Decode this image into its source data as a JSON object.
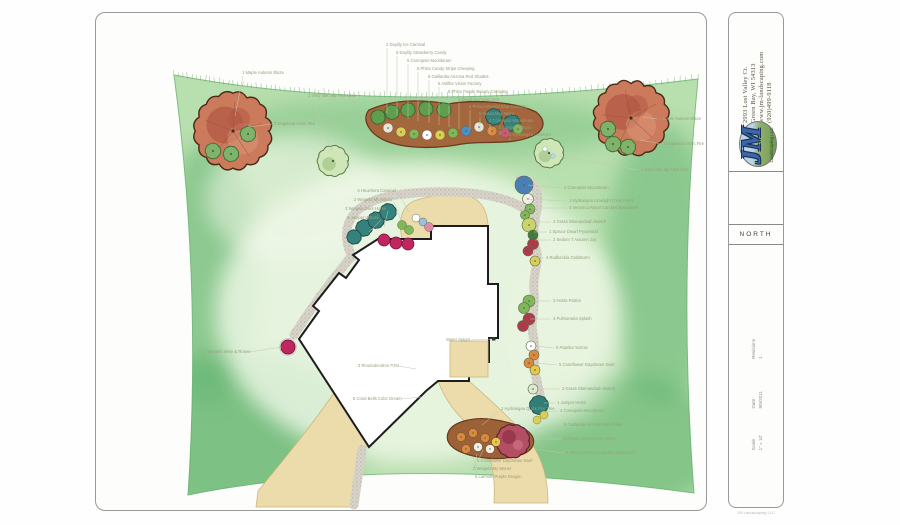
{
  "sidebar": {
    "contact_lines": [
      "2993 Lost Valley Ct.",
      "Green Bay, WI 54313",
      "www.jm-landscaping.com",
      "(920)499-9118"
    ],
    "logo": {
      "initials": "JM",
      "subtitle": "Landscaping LLC"
    },
    "north_label": "NORTH",
    "titleblock": [
      {
        "label": "Revisions",
        "value": "1"
      },
      {
        "label": "Date",
        "value": "9/9/2011"
      },
      {
        "label": "Scale",
        "value": "1\" = 10'"
      }
    ],
    "fine_print": "JM Landscaping LLC"
  },
  "plan": {
    "colors": {
      "lawn_light": "#d5ecc6",
      "lawn_mid": "#9ed29b",
      "lawn_dark": "#55ad68",
      "bed_brown": "#a4663c",
      "bed_outline": "#6b3a1d",
      "tree_red": "#cc7a5c",
      "tree_red_dark": "#b05542",
      "island_tree": "#b34f63",
      "tan": "#ecdcab",
      "tan_edge": "#cdb77e",
      "paver": "#d8d4ca",
      "paver_dot": "#9a958a",
      "house_fill": "#ffffff",
      "house_line": "#1d1d1d",
      "label_text": "#97a07f",
      "leader": "#c2c8ad",
      "juniper_teal": "#35817c",
      "weigela_pink": "#c0275e",
      "shrub_green": "#5f9e4f"
    },
    "labels": [
      {
        "t": "2 Daylily Ice Carnival",
        "x": 290,
        "y": 33,
        "a": "start",
        "l": [
          291,
          35,
          291,
          100
        ]
      },
      {
        "t": "5 Daylily Strawberry Candy",
        "x": 300,
        "y": 41,
        "a": "start",
        "l": [
          301,
          43,
          301,
          103
        ]
      },
      {
        "t": "5 Coreopsis Moonbeam",
        "x": 311,
        "y": 49,
        "a": "start",
        "l": [
          312,
          51,
          312,
          106
        ]
      },
      {
        "t": "5 Phlox Candy Stripe Creeping",
        "x": 321,
        "y": 57,
        "a": "start",
        "l": [
          322,
          59,
          322,
          108
        ]
      },
      {
        "t": "5 Gaillardia Arizona Red Shades",
        "x": 332,
        "y": 65,
        "a": "start",
        "l": [
          333,
          67,
          333,
          110
        ]
      },
      {
        "t": "5 Astilbe Vision Factory",
        "x": 342,
        "y": 72,
        "a": "start",
        "l": [
          343,
          74,
          343,
          112
        ]
      },
      {
        "t": "5 Phlox Purple Beauty Creeping",
        "x": 352,
        "y": 80,
        "a": "start",
        "l": [
          353,
          82,
          353,
          114
        ]
      },
      {
        "t": "5 Dianthus Frosty Fire",
        "x": 362,
        "y": 88,
        "a": "start",
        "l": [
          363,
          90,
          363,
          116
        ]
      },
      {
        "t": "5 Phlox Emerald Blue Creeping",
        "x": 373,
        "y": 95,
        "a": "start",
        "l": [
          374,
          97,
          374,
          117
        ]
      },
      {
        "t": "5 Salvia May Night",
        "x": 383,
        "y": 102,
        "a": "start",
        "l": [
          384,
          104,
          384,
          119
        ]
      },
      {
        "t": "4 Coreopsis Moonbeam",
        "x": 393,
        "y": 109,
        "a": "start",
        "l": [
          394,
          111,
          394,
          120
        ]
      },
      {
        "t": "4 Juniper Wiltonii",
        "x": 403,
        "y": 116,
        "a": "start",
        "l": [
          404,
          118,
          404,
          122
        ]
      },
      {
        "t": "2 Hydrangea Limelight",
        "x": 413,
        "y": 123,
        "a": "start",
        "l": [
          414,
          125,
          414,
          127
        ]
      },
      {
        "t": "1 Maple Autumn Blaze",
        "x": 146,
        "y": 61,
        "a": "start",
        "l": [
          147,
          63,
          139,
          103
        ]
      },
      {
        "t": "3 Dogwood Arctic Fire",
        "x": 178,
        "y": 112,
        "a": "start",
        "l": [
          176,
          111,
          152,
          114
        ]
      },
      {
        "t": "1 Ivory Silk Jap Tree Lilac",
        "x": 212,
        "y": 84,
        "a": "start",
        "l": [
          216,
          86,
          236,
          138
        ]
      },
      {
        "t": "1 Maple Autumn Blaze",
        "x": 563,
        "y": 107,
        "a": "start",
        "l": [
          561,
          106,
          547,
          104
        ]
      },
      {
        "t": "3 Dogwood Arctic Fire",
        "x": 567,
        "y": 132,
        "a": "start",
        "l": [
          565,
          131,
          544,
          127
        ]
      },
      {
        "t": "1 Ivory Silk Jap Tree Lilac",
        "x": 545,
        "y": 158,
        "a": "start",
        "l": [
          543,
          157,
          463,
          143
        ]
      },
      {
        "t": "3 Heuchera Caramel",
        "x": 300,
        "y": 179,
        "a": "end",
        "l": [
          302,
          180,
          313,
          199
        ]
      },
      {
        "t": "2 Weigela My Monet",
        "x": 296,
        "y": 188,
        "a": "end",
        "l": [
          298,
          189,
          305,
          207
        ]
      },
      {
        "t": "3 Weigela Dark Horse",
        "x": 290,
        "y": 197,
        "a": "end",
        "l": [
          292,
          198,
          288,
          214
        ]
      },
      {
        "t": "5 Juniper Wiltonii",
        "x": 283,
        "y": 206,
        "a": "end",
        "l": [
          285,
          207,
          273,
          219
        ]
      },
      {
        "t": "4 Coreopsis Moonbeam",
        "x": 468,
        "y": 176,
        "a": "start",
        "l": [
          466,
          175,
          432,
          172
        ]
      },
      {
        "t": "1 Hydrangea Limelight (Tree Form)",
        "x": 473,
        "y": 189,
        "a": "start",
        "l": [
          471,
          188,
          430,
          186
        ]
      },
      {
        "t": "4 Veronica Royal Candles Speedwell",
        "x": 473,
        "y": 196,
        "a": "start",
        "l": [
          471,
          195,
          432,
          195
        ]
      },
      {
        "t": "4 Grass Shenandoah Switch",
        "x": 457,
        "y": 210,
        "a": "start",
        "l": [
          455,
          209,
          436,
          209
        ]
      },
      {
        "t": "1 Spruce Dwarf Pyramidal",
        "x": 453,
        "y": 220,
        "a": "start",
        "l": [
          451,
          219,
          438,
          219
        ]
      },
      {
        "t": "2 Sedum T Autumn Joy",
        "x": 457,
        "y": 228,
        "a": "start",
        "l": [
          455,
          227,
          439,
          227
        ]
      },
      {
        "t": "4 Rudbeckia Goldsturm",
        "x": 450,
        "y": 246,
        "a": "start",
        "l": [
          448,
          245,
          438,
          245
        ]
      },
      {
        "t": "3 Hosta Patriot",
        "x": 457,
        "y": 289,
        "a": "start",
        "l": [
          455,
          288,
          437,
          288
        ]
      },
      {
        "t": "4 Pulmonaria Splash",
        "x": 457,
        "y": 307,
        "a": "start",
        "l": [
          455,
          306,
          434,
          306
        ]
      },
      {
        "t": "5 Paprika Yarrow",
        "x": 460,
        "y": 336,
        "a": "start",
        "l": [
          458,
          335,
          440,
          333
        ]
      },
      {
        "t": "5 Coneflower Daydream Swirl",
        "x": 463,
        "y": 353,
        "a": "start",
        "l": [
          461,
          352,
          440,
          350
        ]
      },
      {
        "t": "3 Grass Shenandoah Switch",
        "x": 466,
        "y": 377,
        "a": "start",
        "l": [
          464,
          376,
          442,
          376
        ]
      },
      {
        "t": "1 Juniper Hetzii",
        "x": 461,
        "y": 391,
        "a": "start",
        "l": [
          459,
          390,
          448,
          390
        ]
      },
      {
        "t": "4 Coreopsis Moonbeam",
        "x": 464,
        "y": 399,
        "a": "start",
        "l": [
          462,
          398,
          450,
          399
        ]
      },
      {
        "t": "3 Rhododendron PJM",
        "x": 262,
        "y": 354,
        "a": "start",
        "l": [
          303,
          353,
          320,
          356
        ]
      },
      {
        "t": "6 Coral Bells Color Dream",
        "x": 257,
        "y": 387,
        "a": "start",
        "l": [
          305,
          386,
          325,
          384
        ]
      },
      {
        "t": "Water Spigot",
        "x": 350,
        "y": 328,
        "a": "start",
        "l": [
          375,
          327,
          396,
          326
        ]
      },
      {
        "t": "1 Weigela Wine & Roses",
        "x": 108,
        "y": 340,
        "a": "start",
        "l": [
          153,
          339,
          186,
          334
        ]
      },
      {
        "t": "1 Hydrangea Quick Fire Tree",
        "x": 405,
        "y": 397,
        "a": "start",
        "l": [
          403,
          398,
          386,
          412
        ]
      },
      {
        "t": "5 Gaillardia Arizona Red Shade",
        "x": 468,
        "y": 413,
        "a": "start",
        "l": [
          466,
          412,
          443,
          416
        ]
      },
      {
        "t": "1 Flower Carpet Rose White",
        "x": 467,
        "y": 427,
        "a": "start",
        "l": [
          465,
          426,
          439,
          426
        ]
      },
      {
        "t": "4 Veronica Royal Candles Speedwell",
        "x": 470,
        "y": 441,
        "a": "start",
        "l": [
          468,
          440,
          439,
          436
        ]
      },
      {
        "t": "5 Coneflower Daydream Swirl",
        "x": 381,
        "y": 449,
        "a": "start",
        "l": [
          383,
          446,
          387,
          437
        ]
      },
      {
        "t": "2 Weigela My Monet",
        "x": 377,
        "y": 457,
        "a": "start",
        "l": [
          379,
          454,
          381,
          441
        ]
      },
      {
        "t": "5 Lamium Purple Dragon",
        "x": 379,
        "y": 465,
        "a": "start",
        "l": [
          381,
          462,
          377,
          444
        ]
      }
    ]
  }
}
